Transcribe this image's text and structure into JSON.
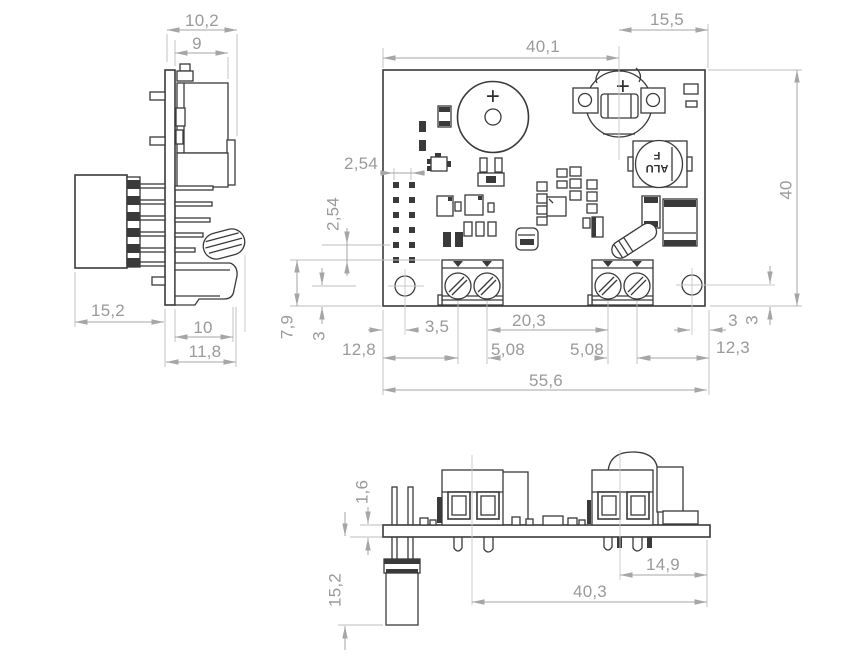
{
  "drawing": {
    "colors": {
      "background": "#ffffff",
      "part_line": "#3a3a3a",
      "dimension_line": "#a6a6a6",
      "dimension_text": "#9a9a9a"
    },
    "left_view": {
      "dims": {
        "overall_width": "10,2",
        "block_width": "9",
        "connector_length": "15,2",
        "block_depth": "10",
        "overall_depth": "11,8"
      }
    },
    "top_view": {
      "dims": {
        "board_width_left": "40,1",
        "board_width_right": "15,5",
        "board_height": "40",
        "pin_pitch_h": "2,54",
        "pin_pitch_v": "2,54",
        "hole_edge_v": "7,9",
        "hole_center_v_left": "3",
        "hole_offset_left": "3,5",
        "terminal_span": "20,3",
        "hole_offset_right": "3",
        "hole_center_v_right": "3",
        "terminal_left_offset": "12,8",
        "terminal_pitch_left": "5,08",
        "terminal_pitch_right": "5,08",
        "terminal_right_offset": "12,3",
        "board_total_width": "55,6"
      },
      "markings": {
        "buzzer_polarity": "+",
        "battery_polarity": "+",
        "inductor_line1": "ALU",
        "inductor_line2": "F"
      }
    },
    "front_view": {
      "dims": {
        "board_thickness": "1,6",
        "probe_length": "15,2",
        "battery_to_edge": "14,9",
        "span": "40,3"
      }
    }
  }
}
